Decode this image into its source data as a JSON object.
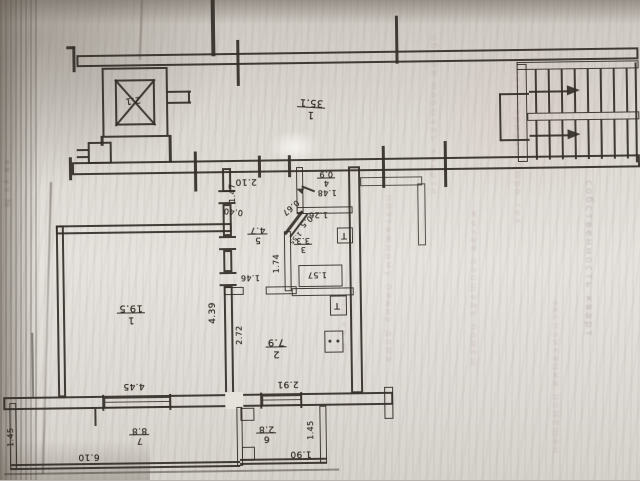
{
  "plan": {
    "corridor": {
      "number": "1",
      "area": "35.1"
    },
    "elevator": {
      "area": "2.1"
    },
    "rooms": {
      "room1": {
        "number": "1",
        "area": "19.5"
      },
      "room2": {
        "number": "2",
        "area": "7.9"
      },
      "room3": {
        "number": "3",
        "area": "3.3"
      },
      "room4": {
        "number": "4",
        "area": "0.9"
      },
      "room5": {
        "number": "5",
        "area": "4.7"
      },
      "room6": {
        "number": "6",
        "area": "2.8"
      },
      "room7": {
        "number": "7",
        "area": "8.8"
      }
    },
    "dims": {
      "d210": "2.10",
      "d147": "1.47",
      "d040": "0.40",
      "d439": "4.39",
      "d445": "4.45",
      "d272": "2.72",
      "d291": "2.91",
      "d174": "1.74",
      "d146": "1.46",
      "d126": "1.26",
      "d148": "1.48",
      "d067": "0.67",
      "d05": "0.5",
      "d155": "1.55",
      "d157": "1.57",
      "d610": "6.10",
      "d190": "1.90",
      "d145l": "1.45",
      "d145r": "1.45"
    },
    "fixtures": {
      "sink_glyph": "Т"
    },
    "ink": "#36312b"
  },
  "ghost": {
    "c1": "поэтажному плану дома",
    "c2": "общая площадь кварти",
    "c3": "жилая площадь помещ",
    "c4": "инвентаризац бюро тех",
    "c5": "собственность кварт",
    "c6": "экспликация помещен",
    "left": "кв уч №",
    "c7": "пл кв м"
  }
}
